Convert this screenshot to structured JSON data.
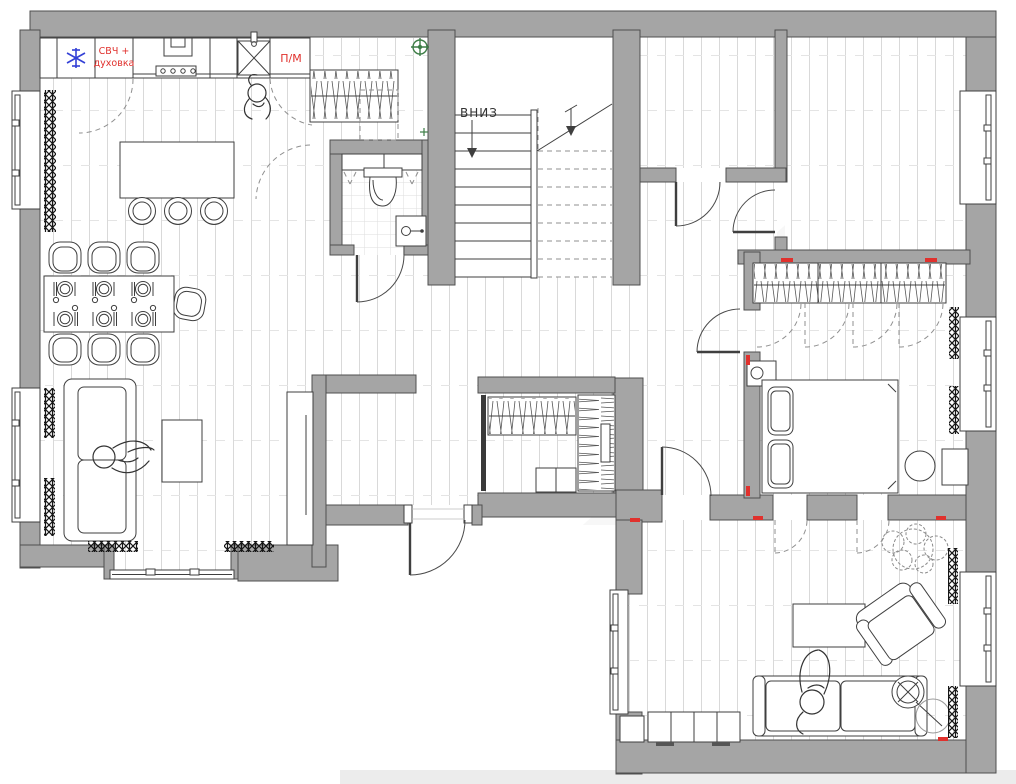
{
  "plan": {
    "type": "apartment-floor-plan",
    "labels": {
      "appliance_line1": "СВЧ +",
      "appliance_line2": "духовка",
      "dishwasher": "П/М",
      "stairs_down": "ВНИЗ"
    },
    "colors": {
      "wall": "#a5a5a5",
      "wall_outline": "#4f4f4f",
      "label_red": "#e0312d",
      "freezer_blue": "#3340d6",
      "marker_green": "#3d7d46",
      "floor_line": "#d9d9d9",
      "curtain_black": "#1a1a1a",
      "stairs_text": "#333333"
    },
    "icons": {
      "freezer": "snowflake-asterisk-icon",
      "survey_marker": "crosshair-circle-icon",
      "sink": "crossed-square-icon",
      "cooktop": "four-burner-icon",
      "floor_lamp": "circle-cross-icon",
      "down_arrow": "arrow-down-icon"
    }
  }
}
